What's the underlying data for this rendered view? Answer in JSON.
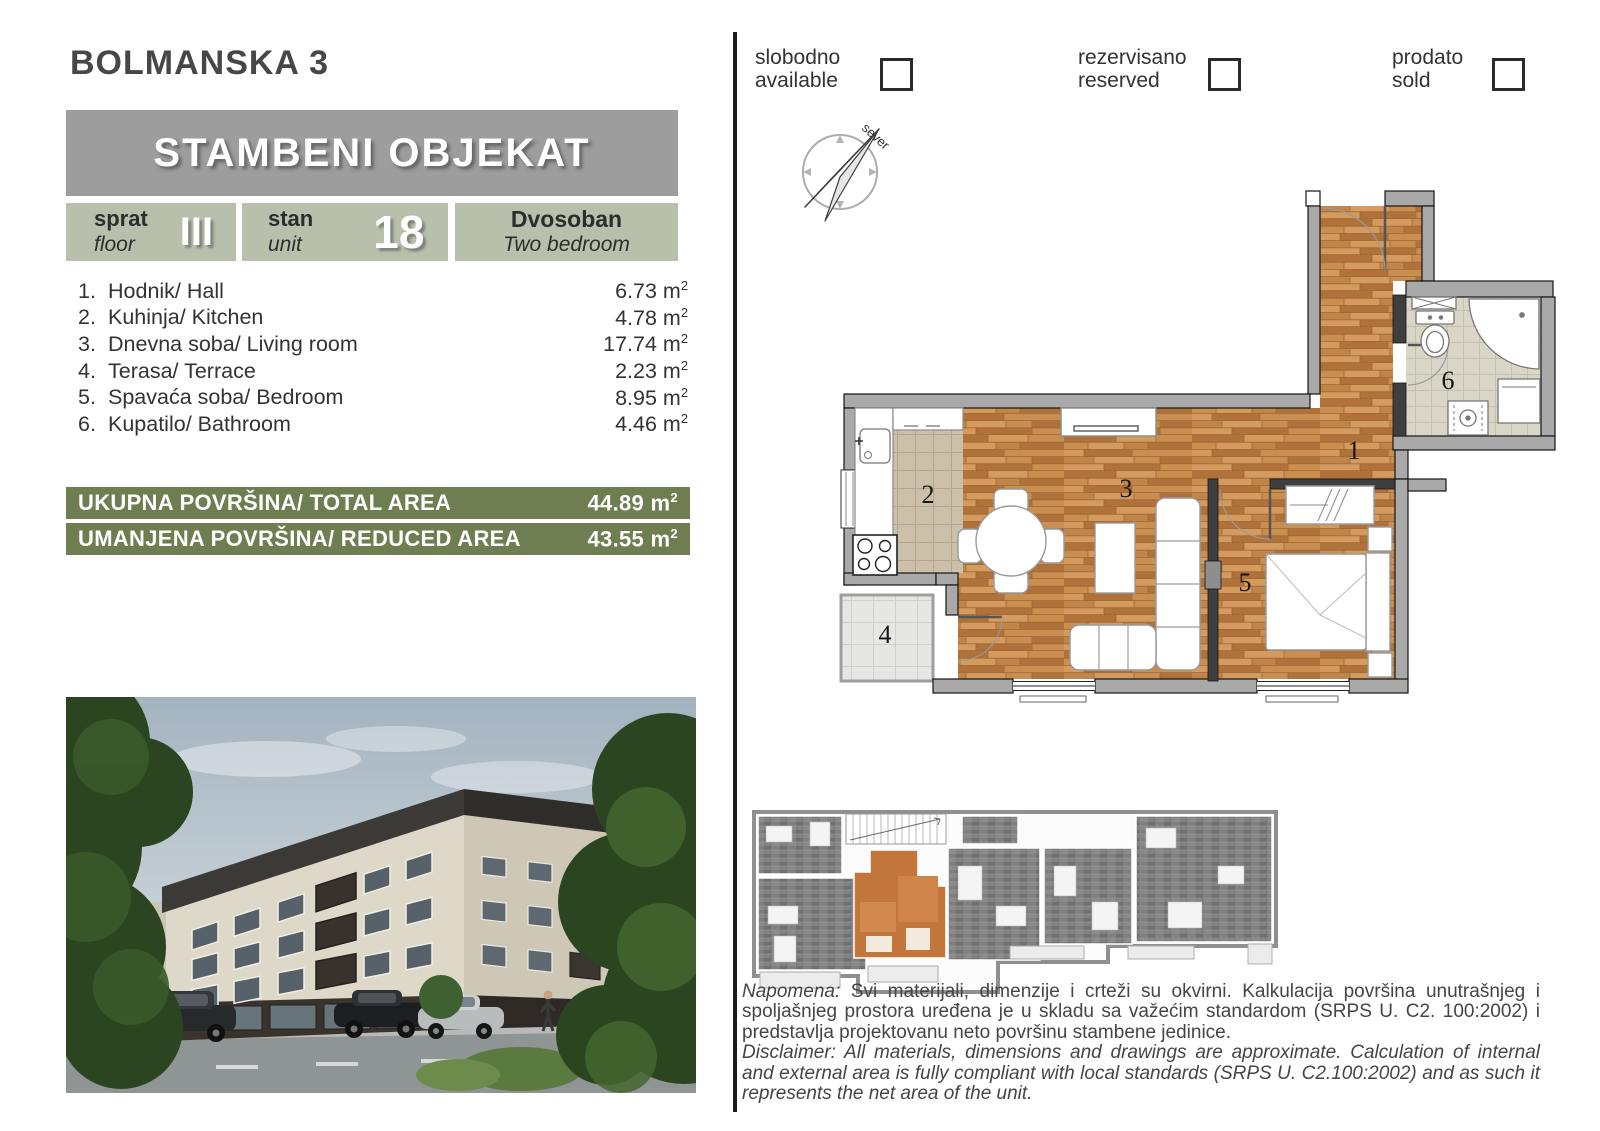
{
  "header": {
    "title": "BOLMANSKA 3",
    "building": "STAMBENI OBJEKAT"
  },
  "unit": {
    "floor_sr": "sprat",
    "floor_en": "floor",
    "floor_value": "III",
    "unit_sr": "stan",
    "unit_en": "unit",
    "unit_value": "18",
    "type_sr": "Dvosoban",
    "type_en": "Two bedroom"
  },
  "labels": {
    "unit_base": "m",
    "unit_sup": "2"
  },
  "rooms": [
    {
      "num": "1.",
      "name": "Hodnik/ Hall",
      "area": "6.73"
    },
    {
      "num": "2.",
      "name": "Kuhinja/ Kitchen",
      "area": "4.78"
    },
    {
      "num": "3.",
      "name": "Dnevna soba/ Living room",
      "area": "17.74"
    },
    {
      "num": "4.",
      "name": "Terasa/ Terrace",
      "area": "2.23"
    },
    {
      "num": "5.",
      "name": "Spavaća soba/ Bedroom",
      "area": "8.95"
    },
    {
      "num": "6.",
      "name": "Kupatilo/ Bathroom",
      "area": "4.46"
    }
  ],
  "totals": [
    {
      "label": "UKUPNA POVRŠINA/ TOTAL AREA",
      "value": "44.89"
    },
    {
      "label": "UMANJENA POVRŠINA/ REDUCED AREA",
      "value": "43.55"
    }
  ],
  "legend": [
    {
      "sr": "slobodno",
      "en": "available"
    },
    {
      "sr": "rezervisano",
      "en": "reserved"
    },
    {
      "sr": "prodato",
      "en": "sold"
    }
  ],
  "compass": {
    "north_label": "sever"
  },
  "floor_plan": {
    "room_numbers": [
      "1",
      "2",
      "3",
      "4",
      "5",
      "6"
    ]
  },
  "notes": {
    "napomena_label": "Napomena:",
    "napomena_text": "Svi materijali, dimenzije i crteži su okvirni. Kalkulacija površina unutrašnjeg i spoljašnjeg prostora uređena je u skladu sa važećim standardom (SRPS U. C2. 100:2002) i predstavlja projektovanu neto površinu stambene jedinice.",
    "disclaimer_label": "Disclaimer:",
    "disclaimer_text": "All materials, dimensions and drawings are approximate. Calculation of internal and external area is fully compliant with local standards (SRPS U. C2.100:2002) and as such it represents the net area of the unit."
  },
  "colors": {
    "accent_green": "#6f7e51",
    "box_sage": "#b8c0ac",
    "band_gray": "#9d9d9d",
    "wood": "#c18449"
  }
}
